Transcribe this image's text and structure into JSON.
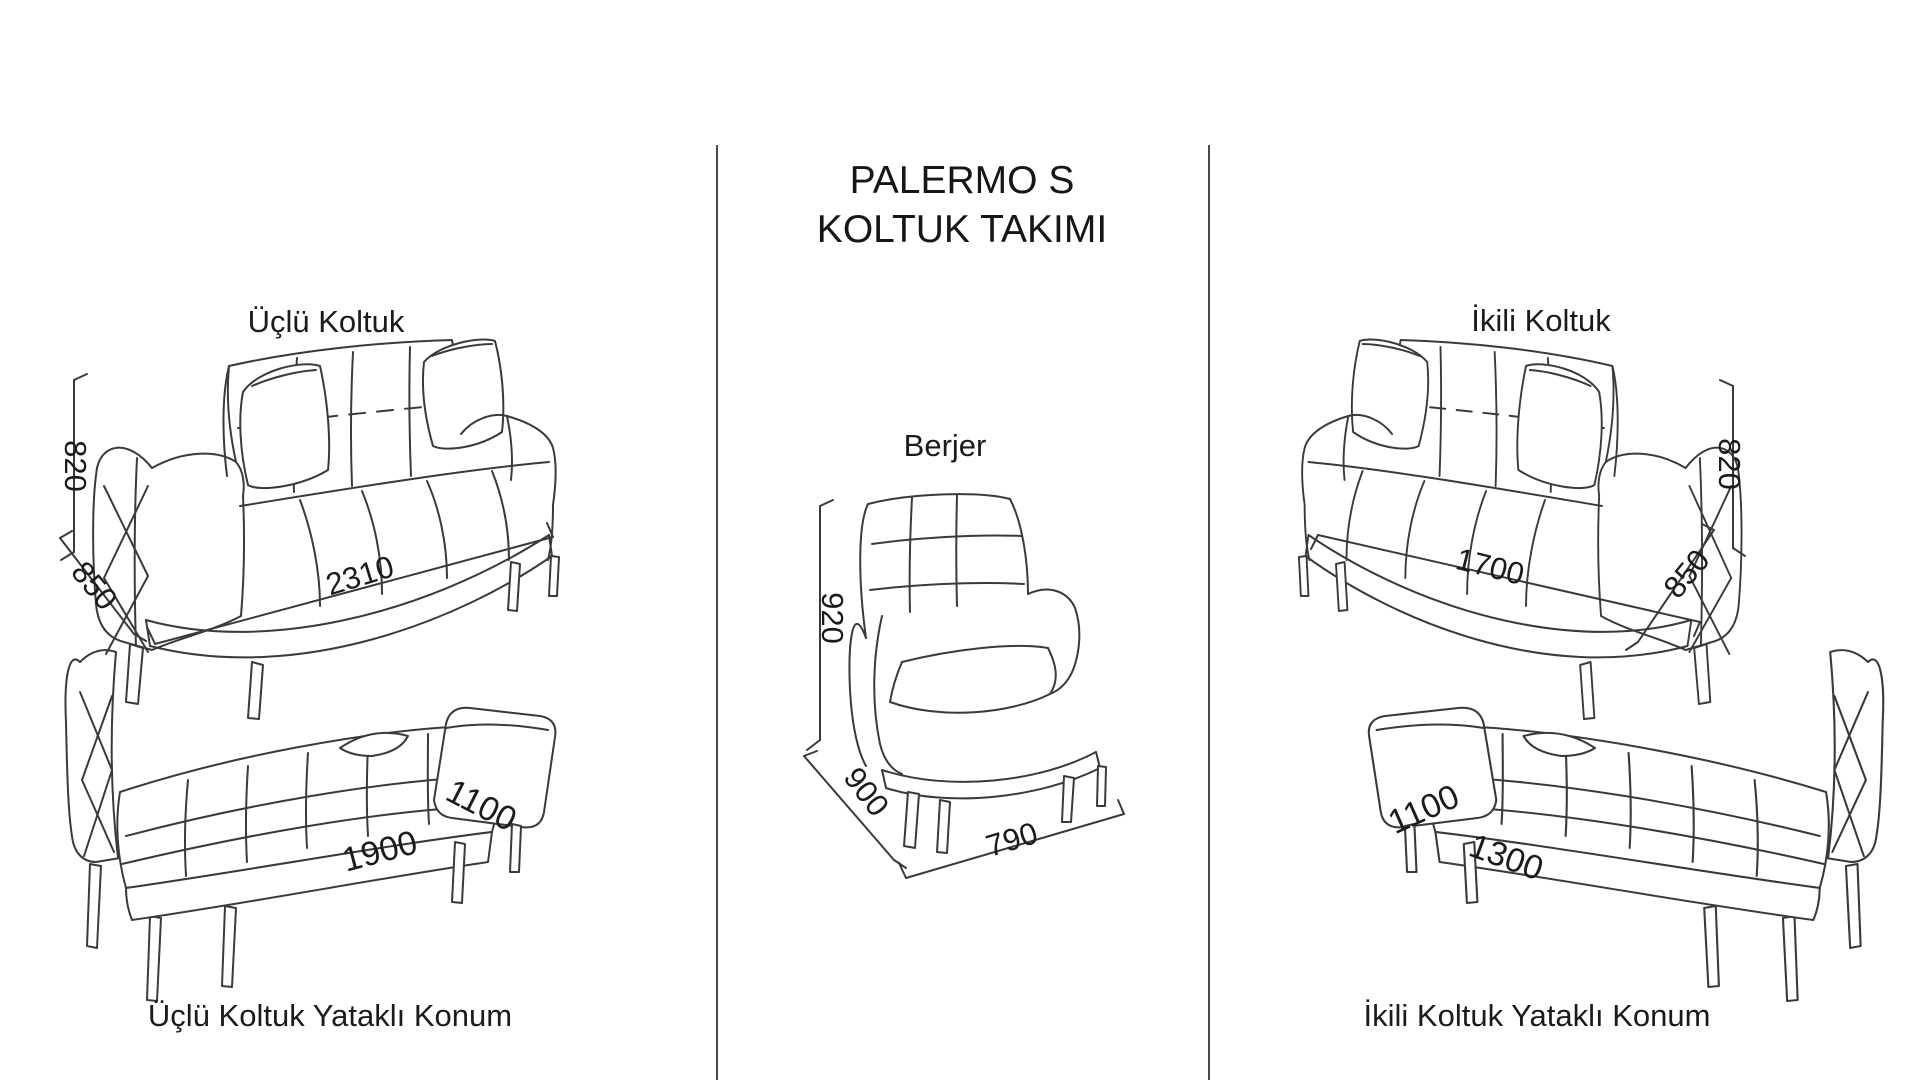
{
  "colors": {
    "background": "#ffffff",
    "line": "#3a3a3a",
    "text": "#1b1b1b"
  },
  "title": {
    "line1": "PALERMO S",
    "line2": "KOLTUK TAKIMI"
  },
  "sections": {
    "three_seater": {
      "label": "Üçlü Koltuk",
      "height_mm": "820",
      "depth_mm": "850",
      "width_mm": "2310"
    },
    "three_seater_bed": {
      "label": "Üçlü Koltuk Yataklı Konum",
      "bed_width_mm": "1100",
      "bed_length_mm": "1900"
    },
    "armchair": {
      "label": "Berjer",
      "height_mm": "920",
      "depth_mm": "900",
      "width_mm": "790"
    },
    "two_seater": {
      "label": "İkili Koltuk",
      "height_mm": "820",
      "depth_mm": "850",
      "width_mm": "1700"
    },
    "two_seater_bed": {
      "label": "İkili Koltuk Yataklı Konum",
      "bed_width_mm": "1100",
      "bed_length_mm": "1300"
    }
  }
}
